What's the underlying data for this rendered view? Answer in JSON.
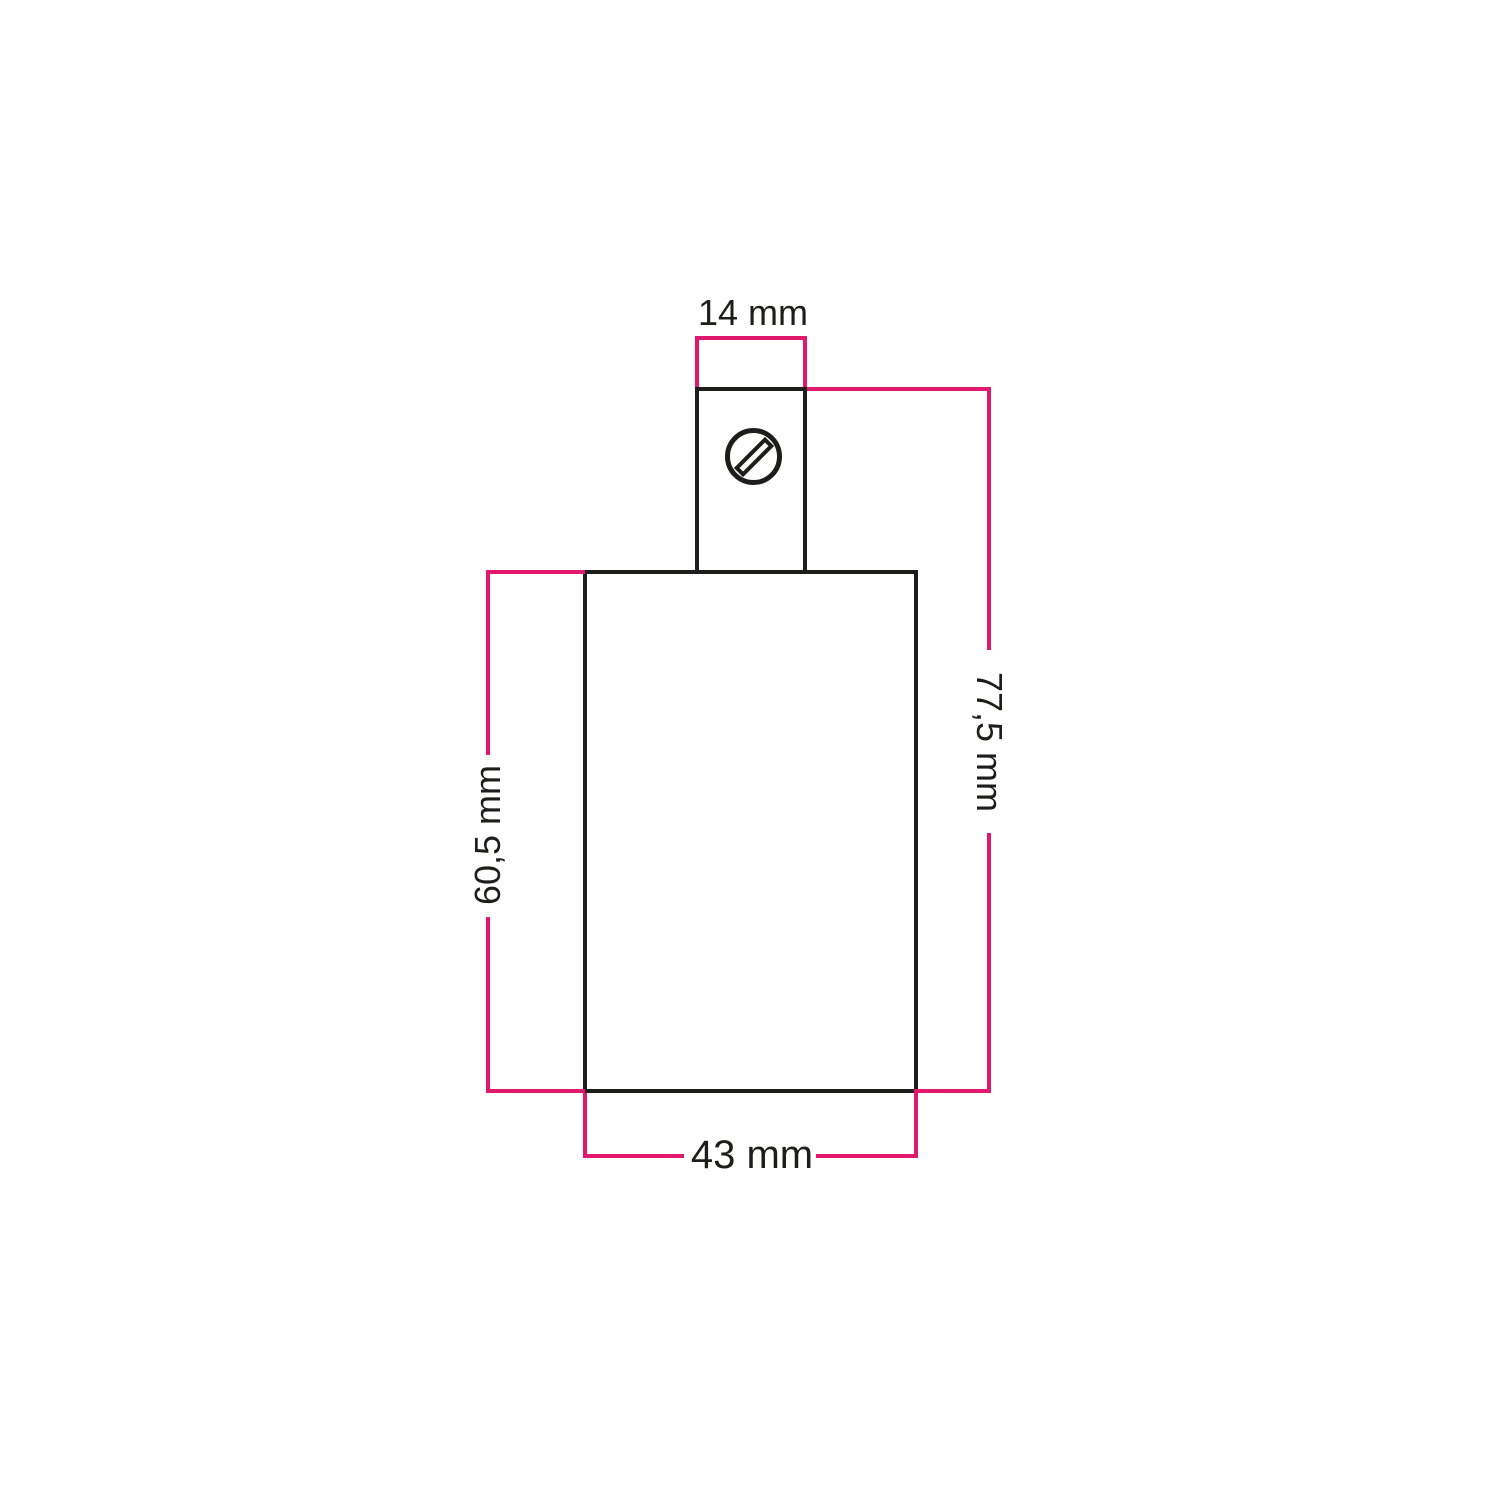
{
  "dimension_labels": {
    "grip_width": "14 mm",
    "overall_height": "77,5 mm",
    "body_height": "60,5 mm",
    "body_width": "43 mm"
  },
  "icons": {
    "screw": "slotted-screw-head-icon"
  },
  "colors": {
    "accent": "#e2186f",
    "ink": "#1d1d1b",
    "bg": "#ffffff"
  }
}
